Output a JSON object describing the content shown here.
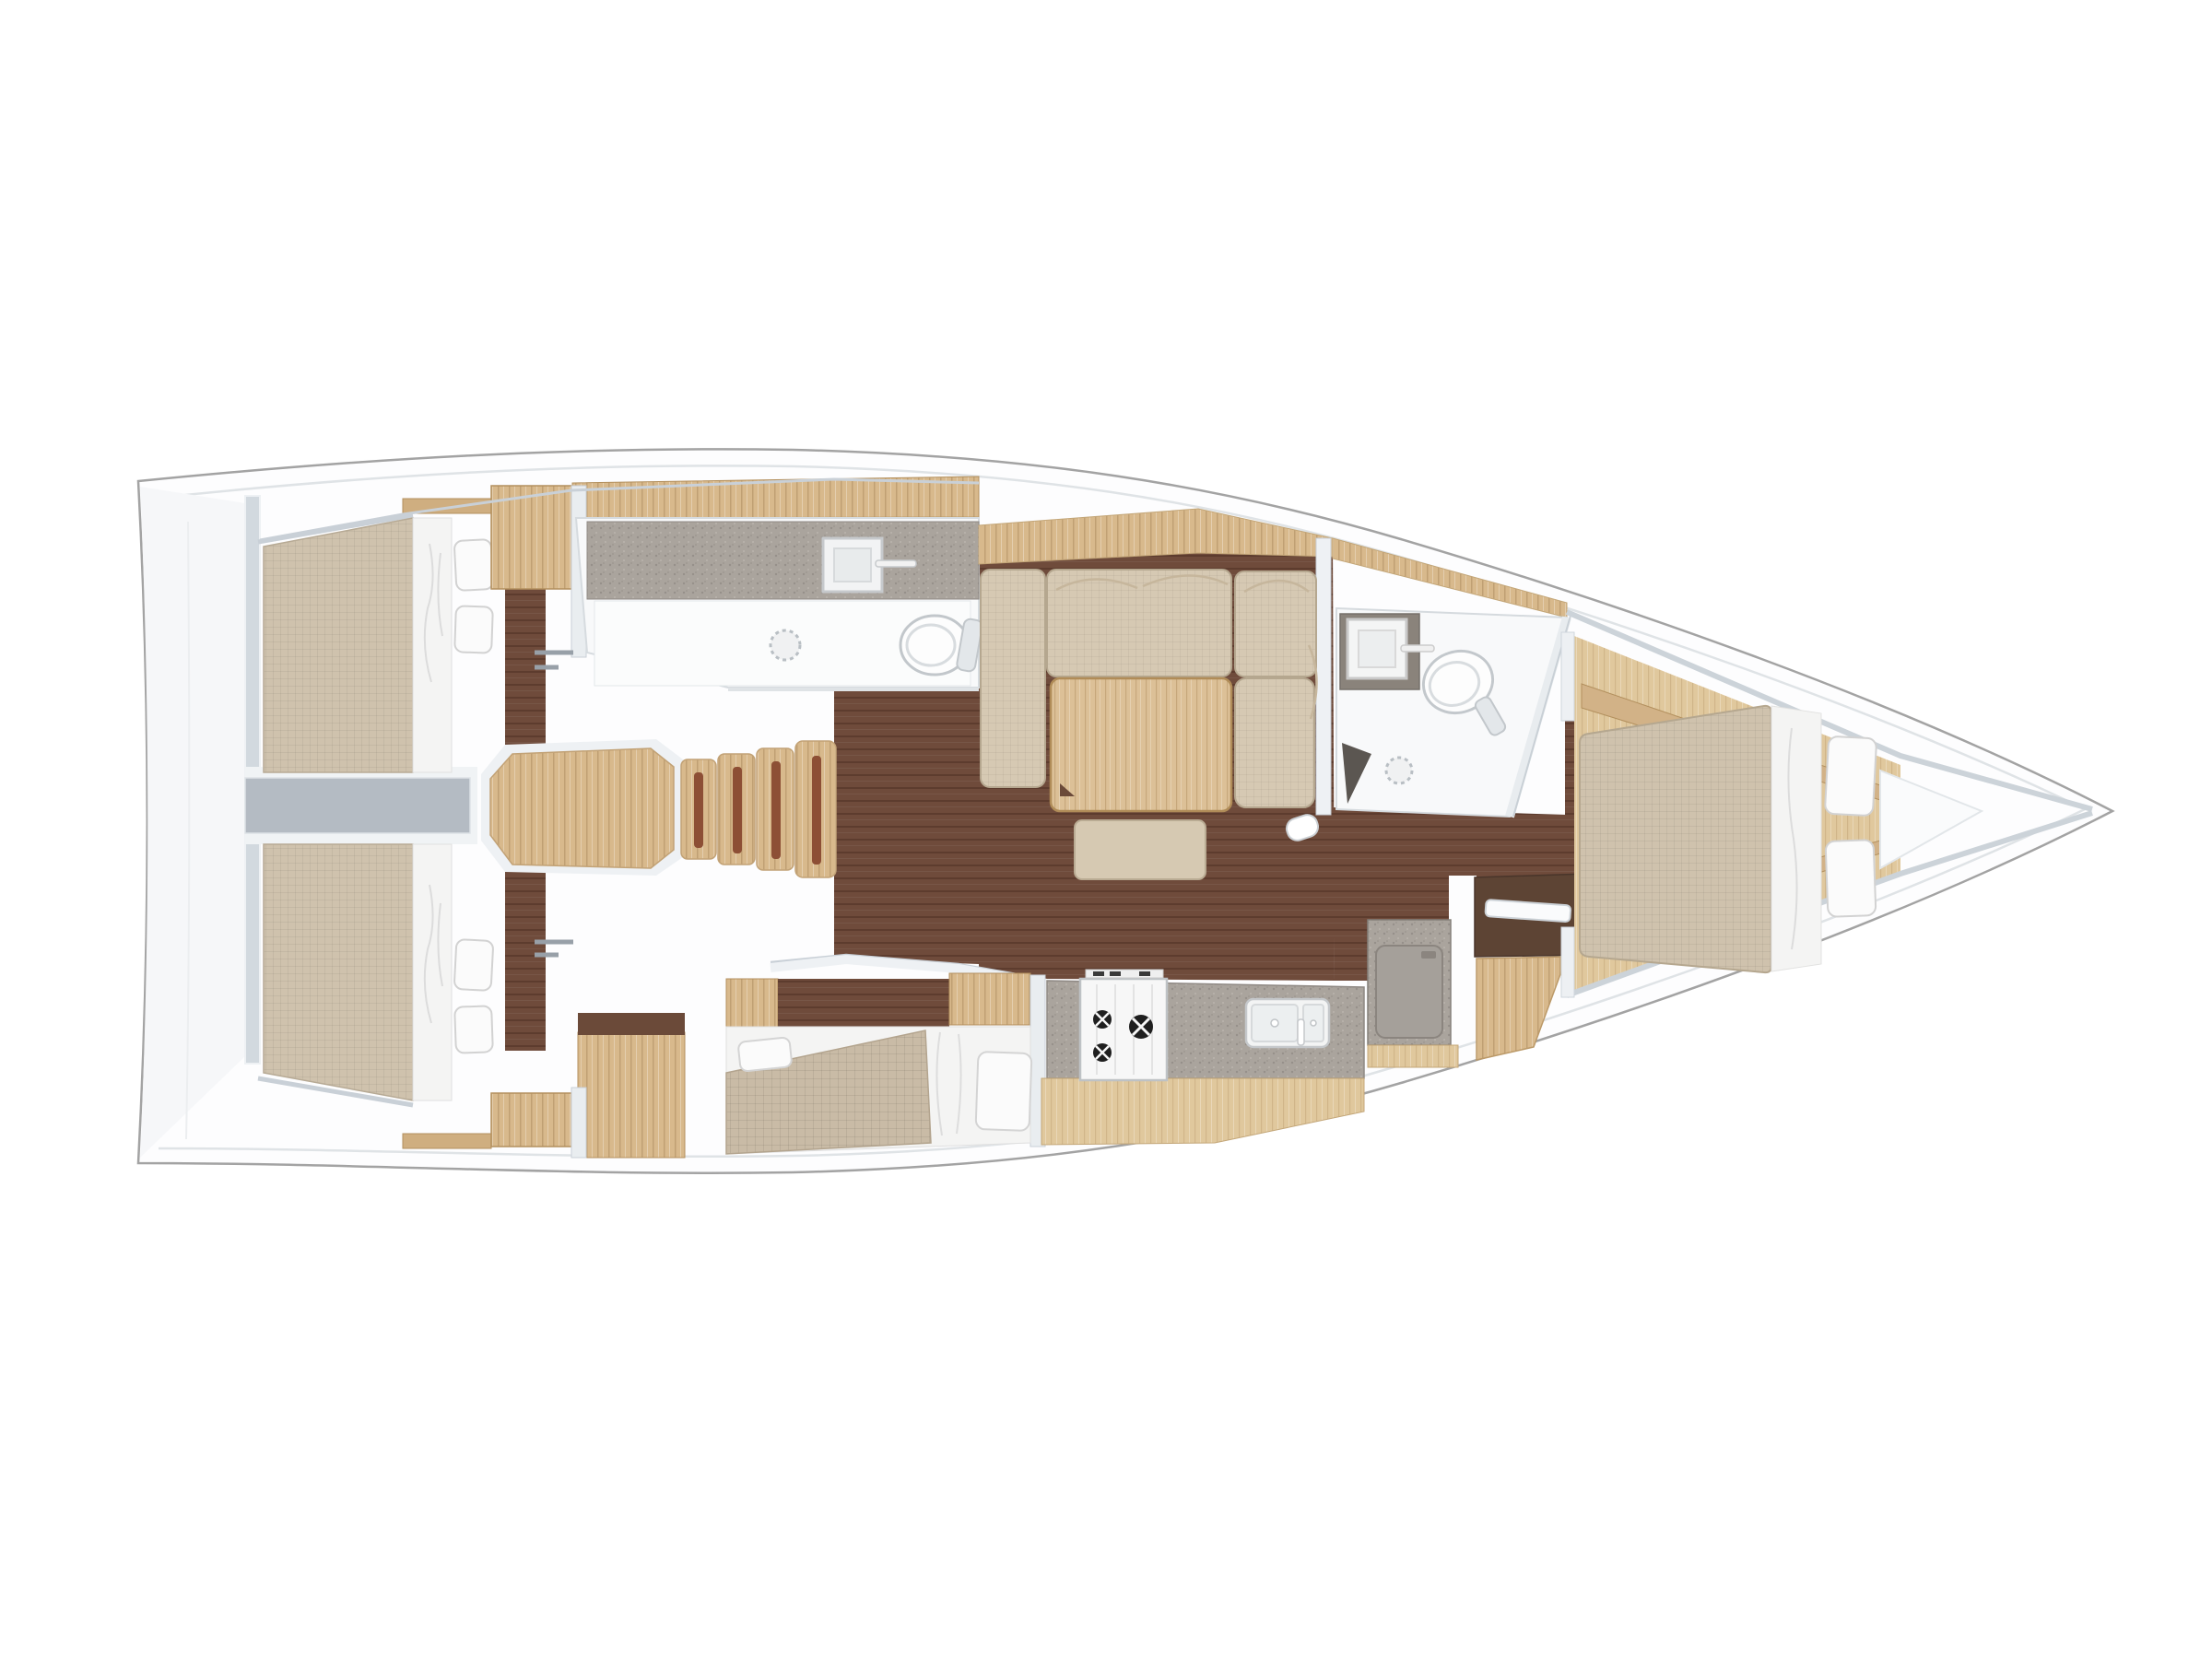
{
  "app": {
    "kind": "yacht-interior-floor-plan",
    "view": "top-down",
    "orientation": "bow-right"
  },
  "colors": {
    "background": "#ffffff",
    "hull": "#fdfdfe",
    "hull_outline": "#a3a3a3",
    "toerail_line": "#dfe3e6",
    "wall": "#e9edf0",
    "wall_edge": "#c9d0d7",
    "corridor_gray": "#b4bbc3",
    "floor_dark_wood": "#6f4b3b",
    "wood_light": "#d8b98c",
    "wood_pale": "#e0c89d",
    "wood_shelf": "#cfae80",
    "table_wood": "#dcc097",
    "stair_strip_brown": "#8d4f35",
    "fabric_mattress": "#cfc2ad",
    "fabric_sofa": "#d6c9b3",
    "fabric_blanket": "#c9bba6",
    "linen_white": "#f4f4f3",
    "bath_floor": "#f8f9fa",
    "counter_speckle": "#aaa49d",
    "fridge_gray": "#a5a09a",
    "desk_dark_wood": "#5d4434",
    "vanity_dark": "#8a837b",
    "shower_seat_dark": "#5b5651",
    "burner_black": "#1f1f1f"
  },
  "rooms": [
    {
      "name": "aft-cabin-port",
      "fixtures": [
        "double-berth",
        "pillow",
        "pillow",
        "wardrobe",
        "shelf"
      ]
    },
    {
      "name": "aft-cabin-starboard",
      "fixtures": [
        "double-berth",
        "pillow",
        "pillow",
        "wardrobe",
        "shelf"
      ]
    },
    {
      "name": "engine-compartment",
      "fixtures": [
        "access-corridor"
      ]
    },
    {
      "name": "companionway",
      "fixtures": [
        "landing",
        "step",
        "step",
        "step",
        "step"
      ]
    },
    {
      "name": "aft-head",
      "fixtures": [
        "counter",
        "sink",
        "faucet",
        "toilet",
        "shower-drain"
      ]
    },
    {
      "name": "saloon",
      "fixtures": [
        "u-shaped-sofa",
        "folding-table",
        "ottoman-bench",
        "mast-post"
      ]
    },
    {
      "name": "midship-berth",
      "fixtures": [
        "double-berth",
        "pillow",
        "pillow",
        "blanket"
      ]
    },
    {
      "name": "galley",
      "fixtures": [
        "counter",
        "stove-three-burner",
        "double-sink",
        "faucet",
        "top-loading-fridge"
      ]
    },
    {
      "name": "forward-head",
      "fixtures": [
        "vanity",
        "sink",
        "faucet",
        "toilet",
        "shower-drain",
        "shower-seat"
      ]
    },
    {
      "name": "nav-station",
      "fixtures": [
        "chart-desk",
        "seat",
        "door-leaf"
      ]
    },
    {
      "name": "forward-cabin",
      "fixtures": [
        "island-double-berth",
        "pillow",
        "pillow",
        "side-shelf",
        "side-shelf",
        "bow-platform"
      ]
    }
  ]
}
